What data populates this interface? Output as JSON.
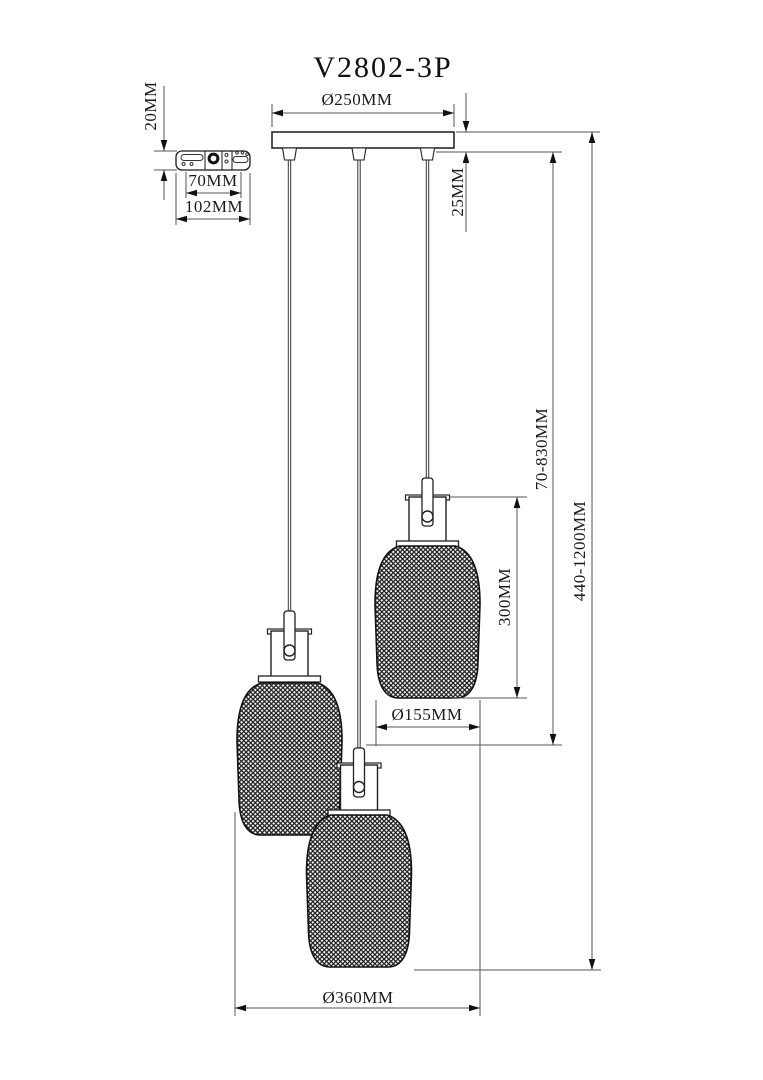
{
  "labels": {
    "title": "V2802-3P",
    "canopy_diameter": "Ø250MM",
    "canopy_drop": "25MM",
    "bracket_height": "20MM",
    "bracket_hole_spacing": "70MM",
    "bracket_width": "102MM",
    "suspension_range": "70-830MM",
    "overall_height_range": "440-1200MM",
    "shade_height": "300MM",
    "shade_diameter": "Ø155MM",
    "spread_diameter": "Ø360MM"
  },
  "colors": {
    "background": "#ffffff",
    "outline": "#111111",
    "dimension_line": "#555555",
    "mesh": "#1c1c1c"
  }
}
